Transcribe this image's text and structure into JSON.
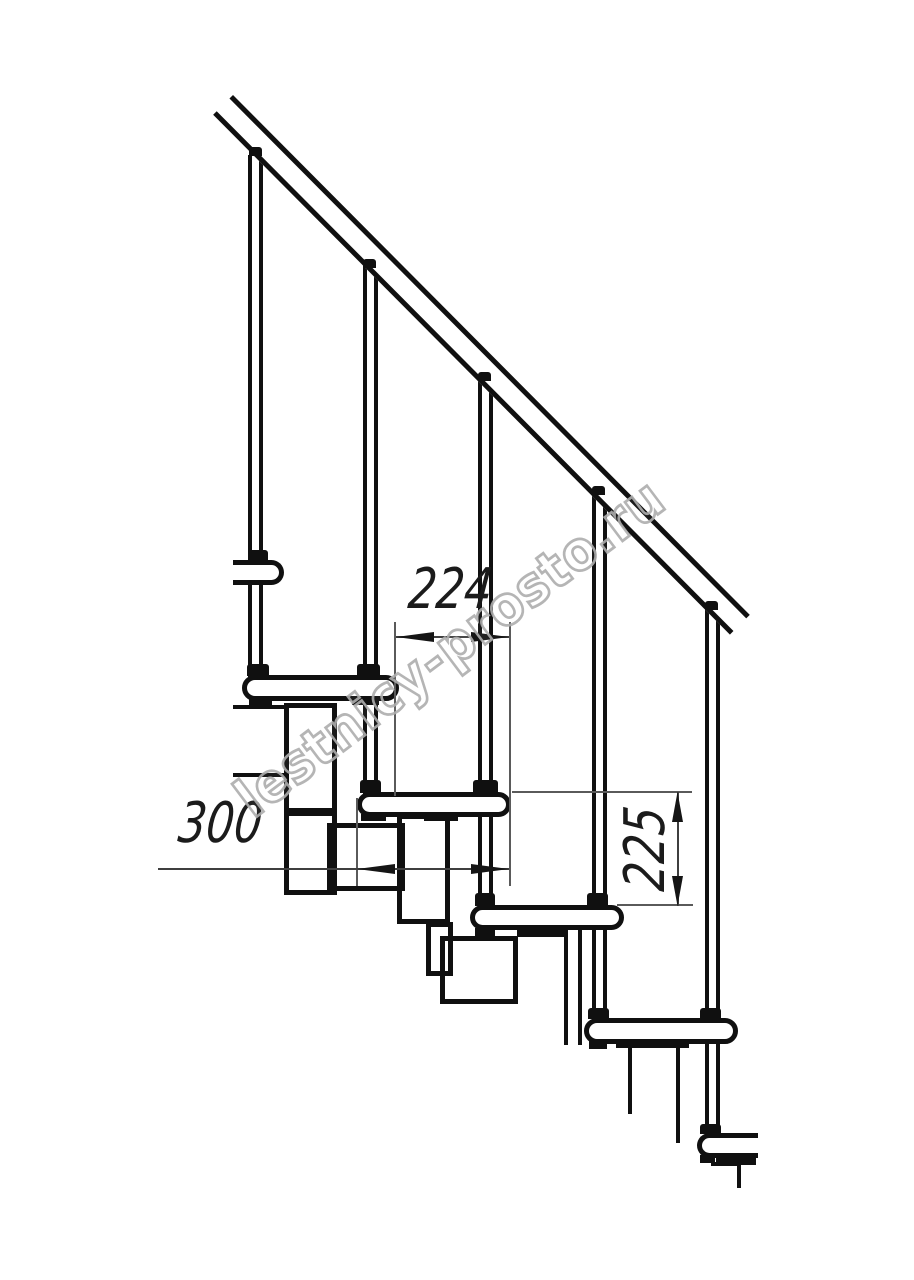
{
  "drawing": {
    "title": "modular-staircase-side-view",
    "line_color": "#101010",
    "dim_color": "#3f3f3f",
    "watermark_color": "#aeaeae"
  },
  "dims": {
    "run": "224",
    "depth": "300",
    "rise": "225"
  },
  "watermark": {
    "text": "lestnicy-prosto.ru"
  }
}
